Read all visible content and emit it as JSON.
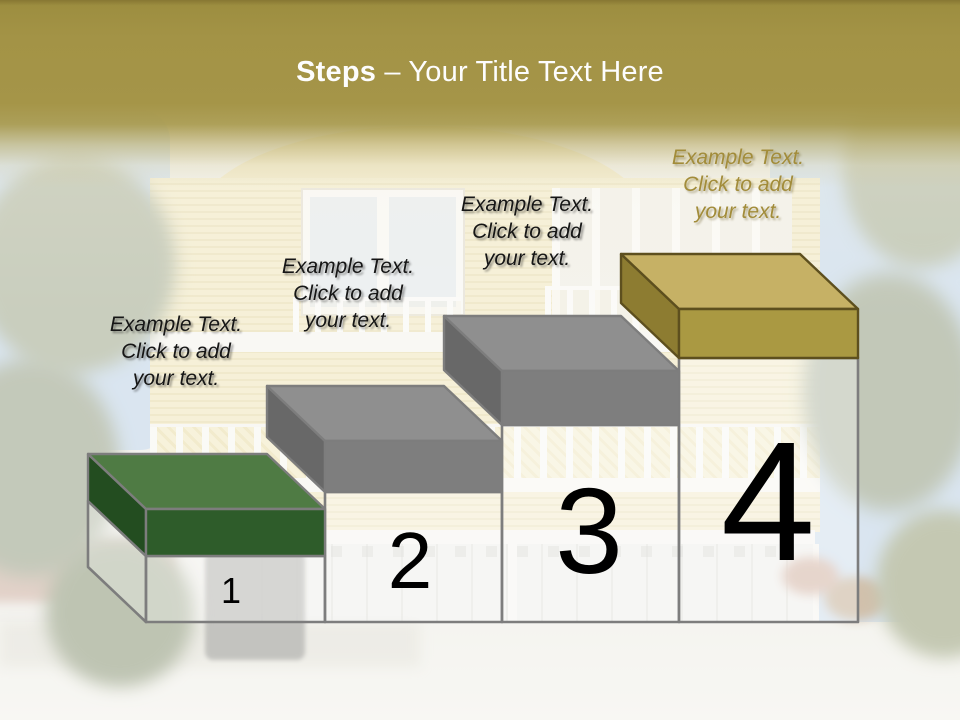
{
  "title": {
    "bold": "Steps",
    "rest": " – Your Title Text Here"
  },
  "steps": [
    {
      "number": "1",
      "label": "Example Text.\nClick  to add\nyour text.",
      "label_color": "#161616",
      "colors": {
        "top": "#4f7b44",
        "front": "#2e5c2a",
        "side": "#234d20",
        "outline": "#7d7d7d"
      }
    },
    {
      "number": "2",
      "label": "Example Text.\nClick  to add\nyour text.",
      "label_color": "#161616",
      "colors": {
        "top": "#8f8f8f",
        "front": "#7e7e7e",
        "side": "#686868",
        "outline": "#7d7d7d"
      }
    },
    {
      "number": "3",
      "label": "Example Text.\nClick  to add\nyour text.",
      "label_color": "#161616",
      "colors": {
        "top": "#8f8f8f",
        "front": "#7e7e7e",
        "side": "#686868",
        "outline": "#7d7d7d"
      }
    },
    {
      "number": "4",
      "label": "Example Text.\nClick  to add\nyour text.",
      "label_color": "#a28c3a",
      "colors": {
        "top": "#c6b165",
        "front": "#aa9942",
        "side": "#8d7c31",
        "outline": "#5d4f1e"
      }
    }
  ],
  "theme": {
    "band_gold": "#a59548",
    "title_color": "#fdfdfd",
    "box_outline": "#7d7d7d"
  }
}
